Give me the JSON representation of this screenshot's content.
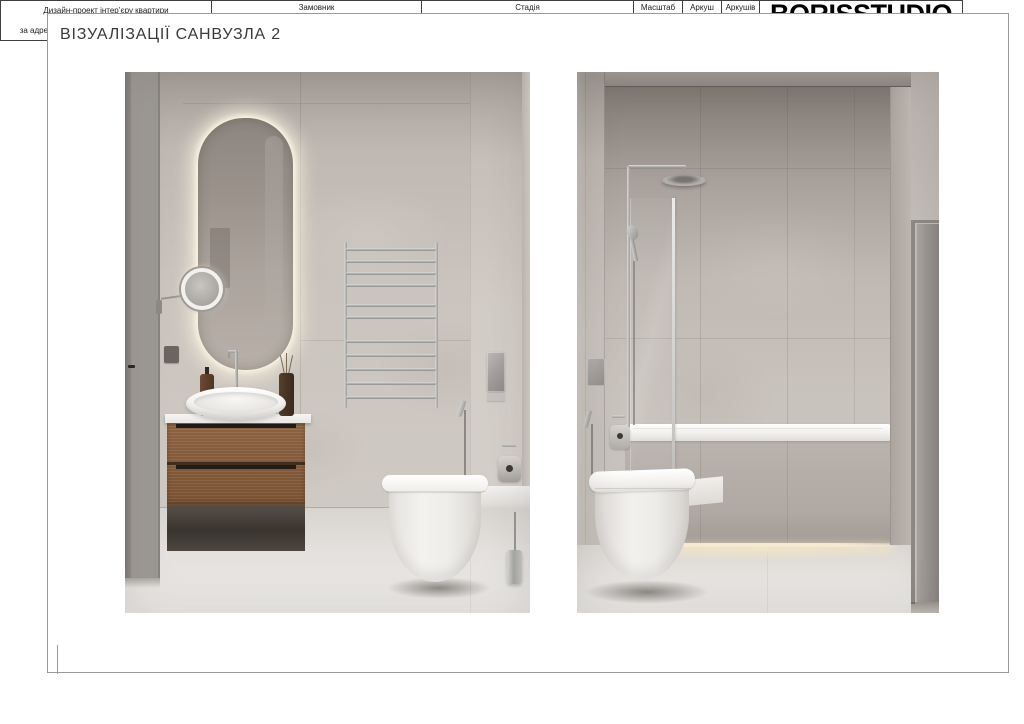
{
  "page": {
    "title": "ВІЗУАЛІЗАЦІЇ САНВУЗЛА 2"
  },
  "title_block": {
    "project_lines": [
      "Дизайн-проект інтер’єру квартири",
      "у ЖК \"Італійський квартал\"",
      "за адресою: м.Київ, вул.Дубищанська 7, кв. 53"
    ],
    "client": {
      "label": "Замовник",
      "value": "Опришко Андрій Олегович"
    },
    "stage": {
      "label": "Стадія",
      "value": "ВІЗУАЛІЗАЦІЇ САНВУЗЛА 2"
    },
    "scale": {
      "label": "Масштаб",
      "value": ""
    },
    "sheet": {
      "label": "Аркуш",
      "value": "19"
    },
    "sheets": {
      "label": "Аркушів",
      "value": "68"
    },
    "logo": {
      "name": "BORISSTUDIO",
      "tagline": "ПЕРШИЙ КРОК ДО МРІЇ"
    }
  },
  "palette": {
    "wall_greige": "#C9C2BC",
    "wall_shadow": "#8D8680",
    "floor": "#E4E1DE",
    "wood_vanity": "#7D5738",
    "chrome": "#B5B5B3",
    "fixture_white": "#F4F2EF",
    "led_glow_warm": "#F3E7CD",
    "frame_line": "#9B9B9B",
    "table_line": "#3F3F3F",
    "text": "#1C1C1C",
    "logo_black": "#000000"
  }
}
